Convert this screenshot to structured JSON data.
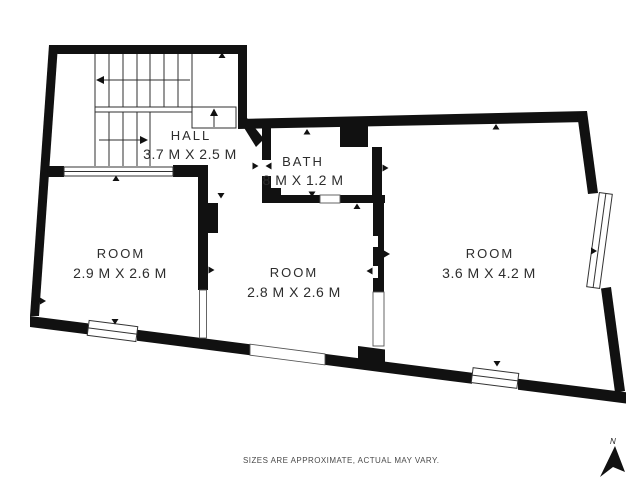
{
  "plan": {
    "rooms": [
      {
        "id": "hall",
        "name": "HALL",
        "dims": "3.7 M X 2.5 M"
      },
      {
        "id": "bath",
        "name": "BATH",
        "dims": "8 M X 1.2 M"
      },
      {
        "id": "room-left",
        "name": "ROOM",
        "dims": "2.9 M X 2.6 M"
      },
      {
        "id": "room-middle",
        "name": "ROOM",
        "dims": "2.8 M X 2.6 M"
      },
      {
        "id": "room-right",
        "name": "ROOM",
        "dims": "3.6 M X 4.2 M"
      }
    ],
    "footer_note": "SIZES ARE APPROXIMATE, ACTUAL MAY VARY.",
    "compass": {
      "label": "N"
    },
    "colors": {
      "wall": "#111111",
      "line": "#2f2f2f",
      "label_text": "#2d2d2d",
      "note_text": "#4a4a4a",
      "background": "#ffffff"
    }
  }
}
